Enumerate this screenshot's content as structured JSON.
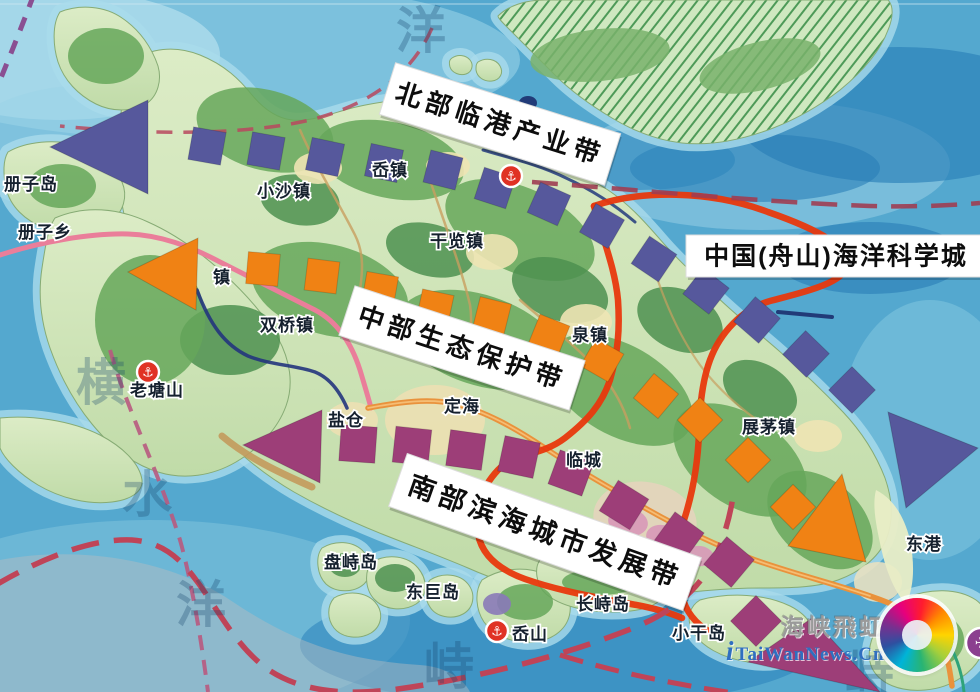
{
  "belts": [
    {
      "name": "north",
      "label": "北部临港产业带",
      "color": "#56589c"
    },
    {
      "name": "central",
      "label": "中部生态保护带",
      "color": "#f08214"
    },
    {
      "name": "south",
      "label": "南部滨海城市发展带",
      "color": "#9d3e78"
    }
  ],
  "science_city": {
    "label": "中国(舟山)海洋科学城",
    "boundary_color": "#e8380d"
  },
  "towns": [
    {
      "name": "册子岛"
    },
    {
      "name": "册子乡"
    },
    {
      "name": "小沙镇"
    },
    {
      "name": "岙镇"
    },
    {
      "name": "干览镇"
    },
    {
      "name": "双桥镇"
    },
    {
      "name": "老塘山"
    },
    {
      "name": "泉镇"
    },
    {
      "name": "盐仓"
    },
    {
      "name": "定海"
    },
    {
      "name": "临城"
    },
    {
      "name": "展茅镇"
    },
    {
      "name": "东港"
    },
    {
      "name": "盘峙岛"
    },
    {
      "name": "东巨岛"
    },
    {
      "name": "长峙岛"
    },
    {
      "name": "岙山"
    },
    {
      "name": "小干岛"
    },
    {
      "name": "镇"
    }
  ],
  "sea_labels": [
    {
      "ch": "洋"
    },
    {
      "ch": "横"
    },
    {
      "ch": "水"
    },
    {
      "ch": "洋"
    },
    {
      "ch": "峙"
    },
    {
      "ch": "峙"
    }
  ],
  "icons": {
    "anchor": "⚓",
    "plane": "✈"
  },
  "watermark": {
    "brand": "海峡飛虹",
    "site_prefix": "i",
    "site": "TaiWanNews.Cn"
  }
}
